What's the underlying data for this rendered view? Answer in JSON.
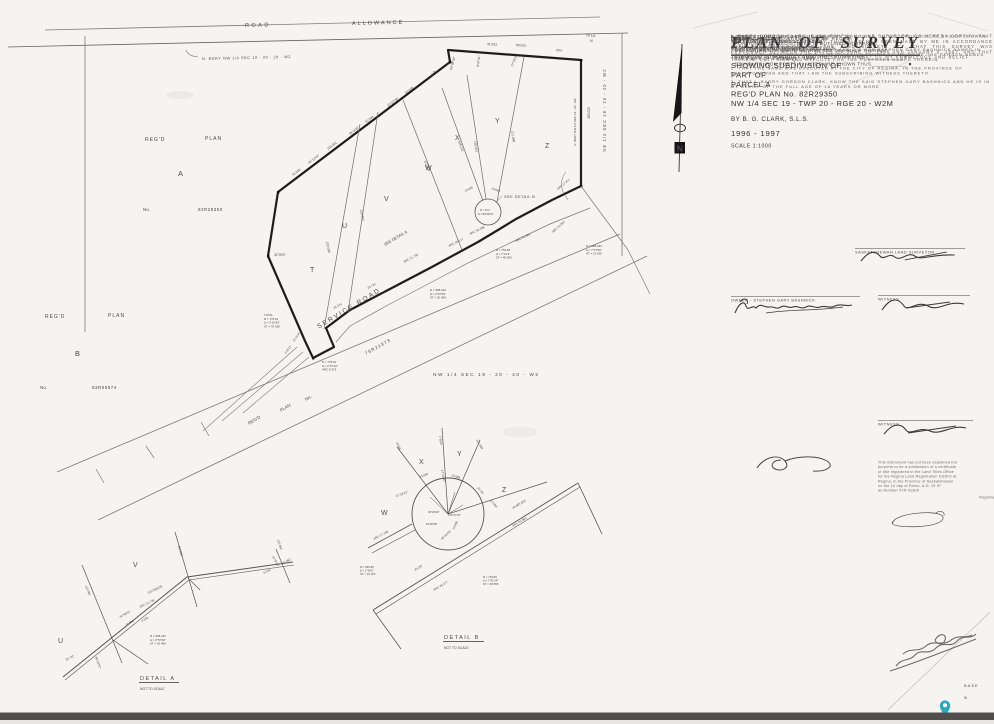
{
  "title_block": {
    "title": "PLAN OF SURVEY",
    "subtitle_lines": [
      "SHOWING SUBDIVISION OF",
      "PART OF",
      "PARCEL A",
      "REG'D PLAN No. 82R29350",
      "NW 1/4 SEC 19 - TWP 20 - RGE 20 - W2M"
    ],
    "by_line": "BY    B. G. CLARK, S.L.S.",
    "years": "1996 - 1997",
    "scale": "SCALE  1:1000"
  },
  "notes": {
    "heading": "NOTE:",
    "items": [
      "- PORTION TO BE REGISTERED IS OUTLINED IN ORANGE",
      "- MEASUREMENTS ARE IN METRES AND DECIMALS THEREOF",
      "- STANDARD IRON POSTS FOUND ARE SHOWN THUS ____________ •",
      "- STANDARD IRON POSTS PLANTED ARE SHOWN THUS____________ ■"
    ]
  },
  "certification": {
    "body": "I, BARRY GORDON CLARK, SASKATCHEWAN LAND SURVEYOR, DO HEREBY CERTIFY THAT THE SURVEY REPRESENTED BY THIS PLAN HAS BEEN MADE BY ME IN ACCORDANCE WITH THE PROVISIONS OF THE LAND SURVEYS ACT, THAT THIS SURVEY WAS PERFORMED BETWEEN THE DATES OF JUNE 18, 1996 AND JANUARY 8, 1997, AND THAT THIS PLAN IS CORRECT AND TRUE TO THE BEST OF MY KNOWLEDGE AND BELIEF.",
    "dated": "DATED AT REGINA, SASKATCHEWAN",
    "this_day": "THIS 24th DAY OF JANUARY, 1997",
    "surveyor_caption": "SASKATCHEWAN LAND SURVEYOR"
  },
  "parties": {
    "owner_caption": "OWNER  -  STEPHEN GARY BASHNICK",
    "witness_caption": "WITNESS",
    "canada": "CANADA",
    "province": "PROVINCE OF SASKATCHEWAN",
    "to_wit": "TO WIT"
  },
  "affidavit": {
    "intro": "I, BARRY GORDON CLARK, OF THE CITY OF REGINA, IN THE PROVINCE OF SASKATCHEWAN MAKE OATH AND SAY:",
    "items": [
      "1. THAT I WAS PERSONALLY PRESENT AND DID SEE STEPHEN GARY BASHNICK NAMED IN THE WITHIN INSTRUMENT WHO IS PERSONALLY KNOWN TO ME TO BE THE PERSON NAMED THEREIN, DULY SIGN AND EXECUTE FOR THE PURPOSES NAMED THEREIN",
      "2. THAT THE SAME WAS EXECUTED AT THE CITY OF REGINA, IN THE PROVINCE OF SASKATCHEWAN AND THAT I AM THE SUBSCRIBING WITNESS THERETO",
      "3. THAT I, BARRY GORDON CLARK, KNOW THE SAID STEPHEN GARY BASHNICK AND HE IS IN MY BELIEF OF THE FULL AGE OF 18 YEARS OR MORE"
    ],
    "sworn_line1": "SWORN BEFORE ME AT THE CITY OF REGINA",
    "sworn_line2": "IN THE PROVINCE OF SASKATCHEWAN",
    "sworn_line3_pre": "THIS 6 DAY OF ",
    "sworn_line3_script": "February",
    "sworn_line3_post": ", 1997",
    "witness_caption": "WITNESS",
    "commissioner_lines": [
      "A COMMISSIONER FOR OATHS IN AND FOR",
      "THE PROVINCE OF SASKATCHEWAN",
      "MY APPOINTMENT EXPIRES"
    ]
  },
  "stamp": {
    "lines": [
      "This instrument has not been examined but",
      "purports to be a subdivision of a certificate",
      "of title registered in the Land Titles Office",
      "for the Regina Land Registration District at",
      "Regina, in the Province of Saskatchewan",
      "on the 14 day of Febru. A.D. 19 97",
      "as Number 97R 01309"
    ],
    "registrar": "Registrar"
  },
  "margin": {
    "base": "BASE",
    "w_mark": "W"
  },
  "pin": {
    "color": "#2aa9c0"
  },
  "compass": {
    "n": "N"
  },
  "plan": {
    "road": "ROAD",
    "allowance": "ALLOWANCE",
    "tp_corner_l1": "TP 1/4",
    "tp_corner_l2": "M",
    "n_bdry": "N. BDRY NW 1/4 SEC 19 - 20 - 20 - W2",
    "regd_word1": "REG'D",
    "regd_word2": "PLAN",
    "no_label": "No.",
    "parcel_a_letter": "A",
    "parcel_a_num": "82R29350",
    "parcel_b_letter": "B",
    "parcel_b_num": "83R59574",
    "lot_t": "T",
    "lot_u": "U",
    "lot_v": "V",
    "lot_w": "W",
    "lot_x": "X",
    "lot_y": "Y",
    "lot_z": "Z",
    "service_road": "SERVICE ROAD",
    "see_detail_a": "SEE DETAIL A",
    "see_detail_b": "SEE DETAIL B",
    "road_plan": "78R21573",
    "nw_quarter": "NW 1/4 SEC 19 - 20 - 20 - W2",
    "ne_quarter": "NE 1/4 SEC 19 - 20 - 20 - W2",
    "e_bdry": "E. BDRY NW 1/4 SEC 19 - 20 - W2",
    "culdesac_r": "R = 15.0",
    "culdesac_d": "Δ = 89°59'16\"",
    "micro": [
      "45.084",
      "43°13'42\"",
      "105.091",
      "46°3'30\"",
      "43.094",
      "10°57'46\"",
      "43.048",
      "31.8",
      "60°06'32\"",
      "80.003",
      "31.003",
      "28.0",
      "77°29'32\"",
      "9°47'41\"",
      "115.088",
      "113.962",
      "113.800",
      "108.242",
      "135.021",
      "171.088",
      "150.013",
      "13.005",
      "13.688",
      "ARC 21.730",
      "25.742",
      "26.314",
      "ARC 45.177",
      "ARC 36.288",
      "ARC 51.801",
      "ARC 27.313",
      "34°09'0\"",
      "13°51'08\"",
      "8°58'18\"",
      "30.176"
    ],
    "blocks": {
      "total": [
        "TOTAL",
        "R = 778.91",
        "Δ = 2°51'50\"",
        "ST = 78.428"
      ],
      "jog": [
        "R = 778.91",
        "Δ = 2°37'42\"",
        "ARC 8.373"
      ],
      "mid": [
        "R = 958.232",
        "Δ = 2°57'09\"",
        "ST = 20.469"
      ],
      "upper": [
        "R = 753.86",
        "Δ = 7°41'4\"",
        "ST = 48.563"
      ],
      "east": [
        "R = 958.232",
        "Δ = 7°37'50\"",
        "ST = 13.638"
      ]
    }
  },
  "detail_a": {
    "title": "DETAIL A",
    "subtitle": "NOT TO SCALE",
    "lot_u": "U",
    "lot_v": "V",
    "micro": [
      "113.962",
      "112.882",
      "110.682",
      "25.742",
      "86°52'57\"",
      "44°58'31\"",
      "16.094",
      "2.003",
      "ARC 21.730",
      "213.036(23)",
      "5.034",
      "11.082",
      "67°8'10\""
    ],
    "block": [
      "R = 958.232",
      "Δ = 2°57'09\"",
      "ST = 20.469"
    ]
  },
  "detail_b": {
    "title": "DETAIL B",
    "subtitle": "NOT TO SCALE",
    "lot_w": "W",
    "lot_x": "X",
    "lot_y": "Y",
    "lot_z": "Z",
    "micro": [
      "21°32'23\"",
      "13.060",
      "13.688",
      "17°22'30\"",
      "31°35'",
      "27.084",
      "49°29'32\"",
      "100°47'16\"",
      "64°56'38\"",
      "48°34'53\"",
      "13.096",
      "ARC 27.188",
      "45.237",
      "ARC 45.177",
      "46.665 (23)",
      "ARC 51.801",
      "60.08",
      "1°59'4\"",
      "121.088"
    ],
    "block_left": [
      "R = 545.86",
      "Δ = 2°26'5\"",
      "ST = 16.125"
    ],
    "block_right": [
      "R = 733.86",
      "Δ = 7°41'14\"",
      "ST = 48.565"
    ]
  }
}
